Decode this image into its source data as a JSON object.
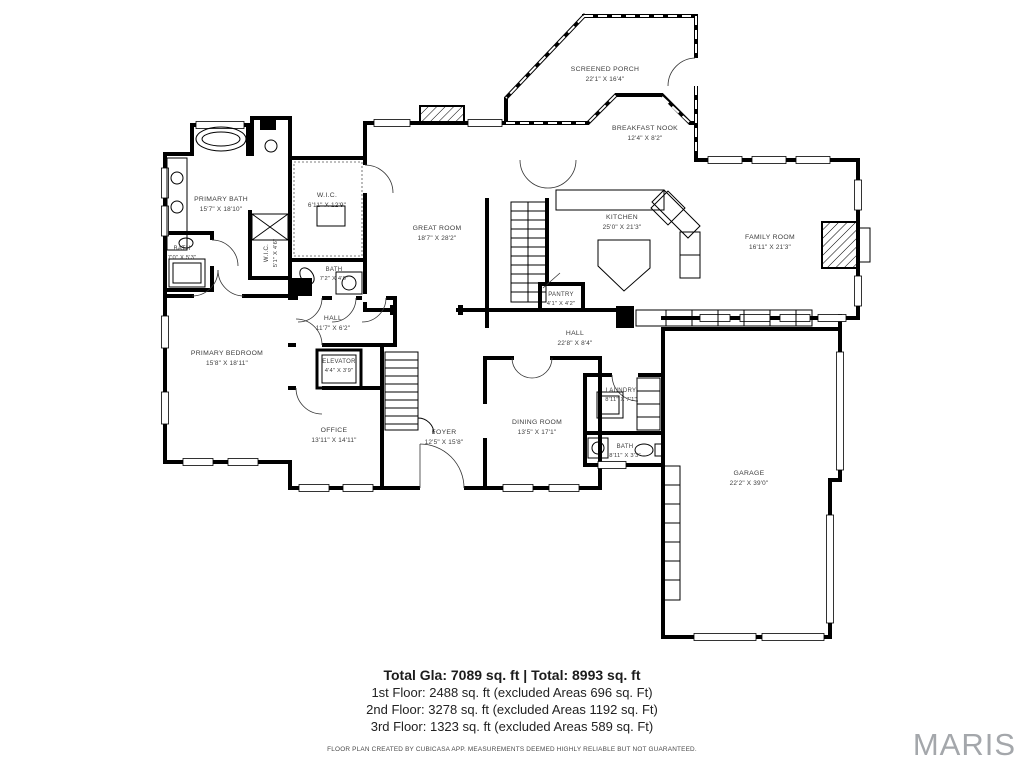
{
  "rooms": [
    {
      "name": "SCREENED PORCH",
      "dims": "22'1\" X 16'4\""
    },
    {
      "name": "BREAKFAST NOOK",
      "dims": "12'4\" X 8'2\""
    },
    {
      "name": "KITCHEN",
      "dims": "25'0\" X 21'3\""
    },
    {
      "name": "FAMILY ROOM",
      "dims": "16'11\" X 21'3\""
    },
    {
      "name": "GREAT ROOM",
      "dims": "18'7\" X 28'2\""
    },
    {
      "name": "PRIMARY BATH",
      "dims": "15'7\" X 18'10\""
    },
    {
      "name": "W.I.C.",
      "dims": "6'11\" X 12'9\""
    },
    {
      "name": "BATH",
      "dims": "7'0\" X 5'3\""
    },
    {
      "name": "W.I.C.",
      "dims": "5'1\" X 4'6\""
    },
    {
      "name": "BATH",
      "dims": "7'2\" X 4'6\""
    },
    {
      "name": "HALL",
      "dims": "11'7\" X 6'2\""
    },
    {
      "name": "PANTRY",
      "dims": "4'1\" X 4'2\""
    },
    {
      "name": "HALL",
      "dims": "22'8\" X 8'4\""
    },
    {
      "name": "PRIMARY BEDROOM",
      "dims": "15'8\" X 18'11\""
    },
    {
      "name": "ELEVATOR",
      "dims": "4'4\" X 3'9\""
    },
    {
      "name": "OFFICE",
      "dims": "13'11\" X 14'11\""
    },
    {
      "name": "FOYER",
      "dims": "12'5\" X 15'8\""
    },
    {
      "name": "DINING ROOM",
      "dims": "13'5\" X 17'1\""
    },
    {
      "name": "LAUNDRY",
      "dims": "8'11\" X 7'1\""
    },
    {
      "name": "BATH",
      "dims": "8'11\" X 3'3\""
    },
    {
      "name": "GARAGE",
      "dims": "22'2\" X 39'0\""
    }
  ],
  "summary": {
    "total": "Total Gla: 7089 sq. ft | Total: 8993 sq. ft",
    "floor1": "1st Floor: 2488 sq. ft (excluded Areas 696 sq. Ft)",
    "floor2": "2nd Floor: 3278 sq. ft (excluded Areas 1192 sq. Ft)",
    "floor3": "3rd Floor: 1323 sq. ft (excluded Areas 589 sq. Ft)"
  },
  "disclaimer": "FLOOR PLAN CREATED BY CUBICASA APP. MEASUREMENTS DEEMED HIGHLY RELIABLE BUT NOT GUARANTEED.",
  "watermark": "MARIS",
  "colors": {
    "wall": "#000000",
    "label": "#3c3c3c",
    "watermark": "#a4a7ab"
  }
}
